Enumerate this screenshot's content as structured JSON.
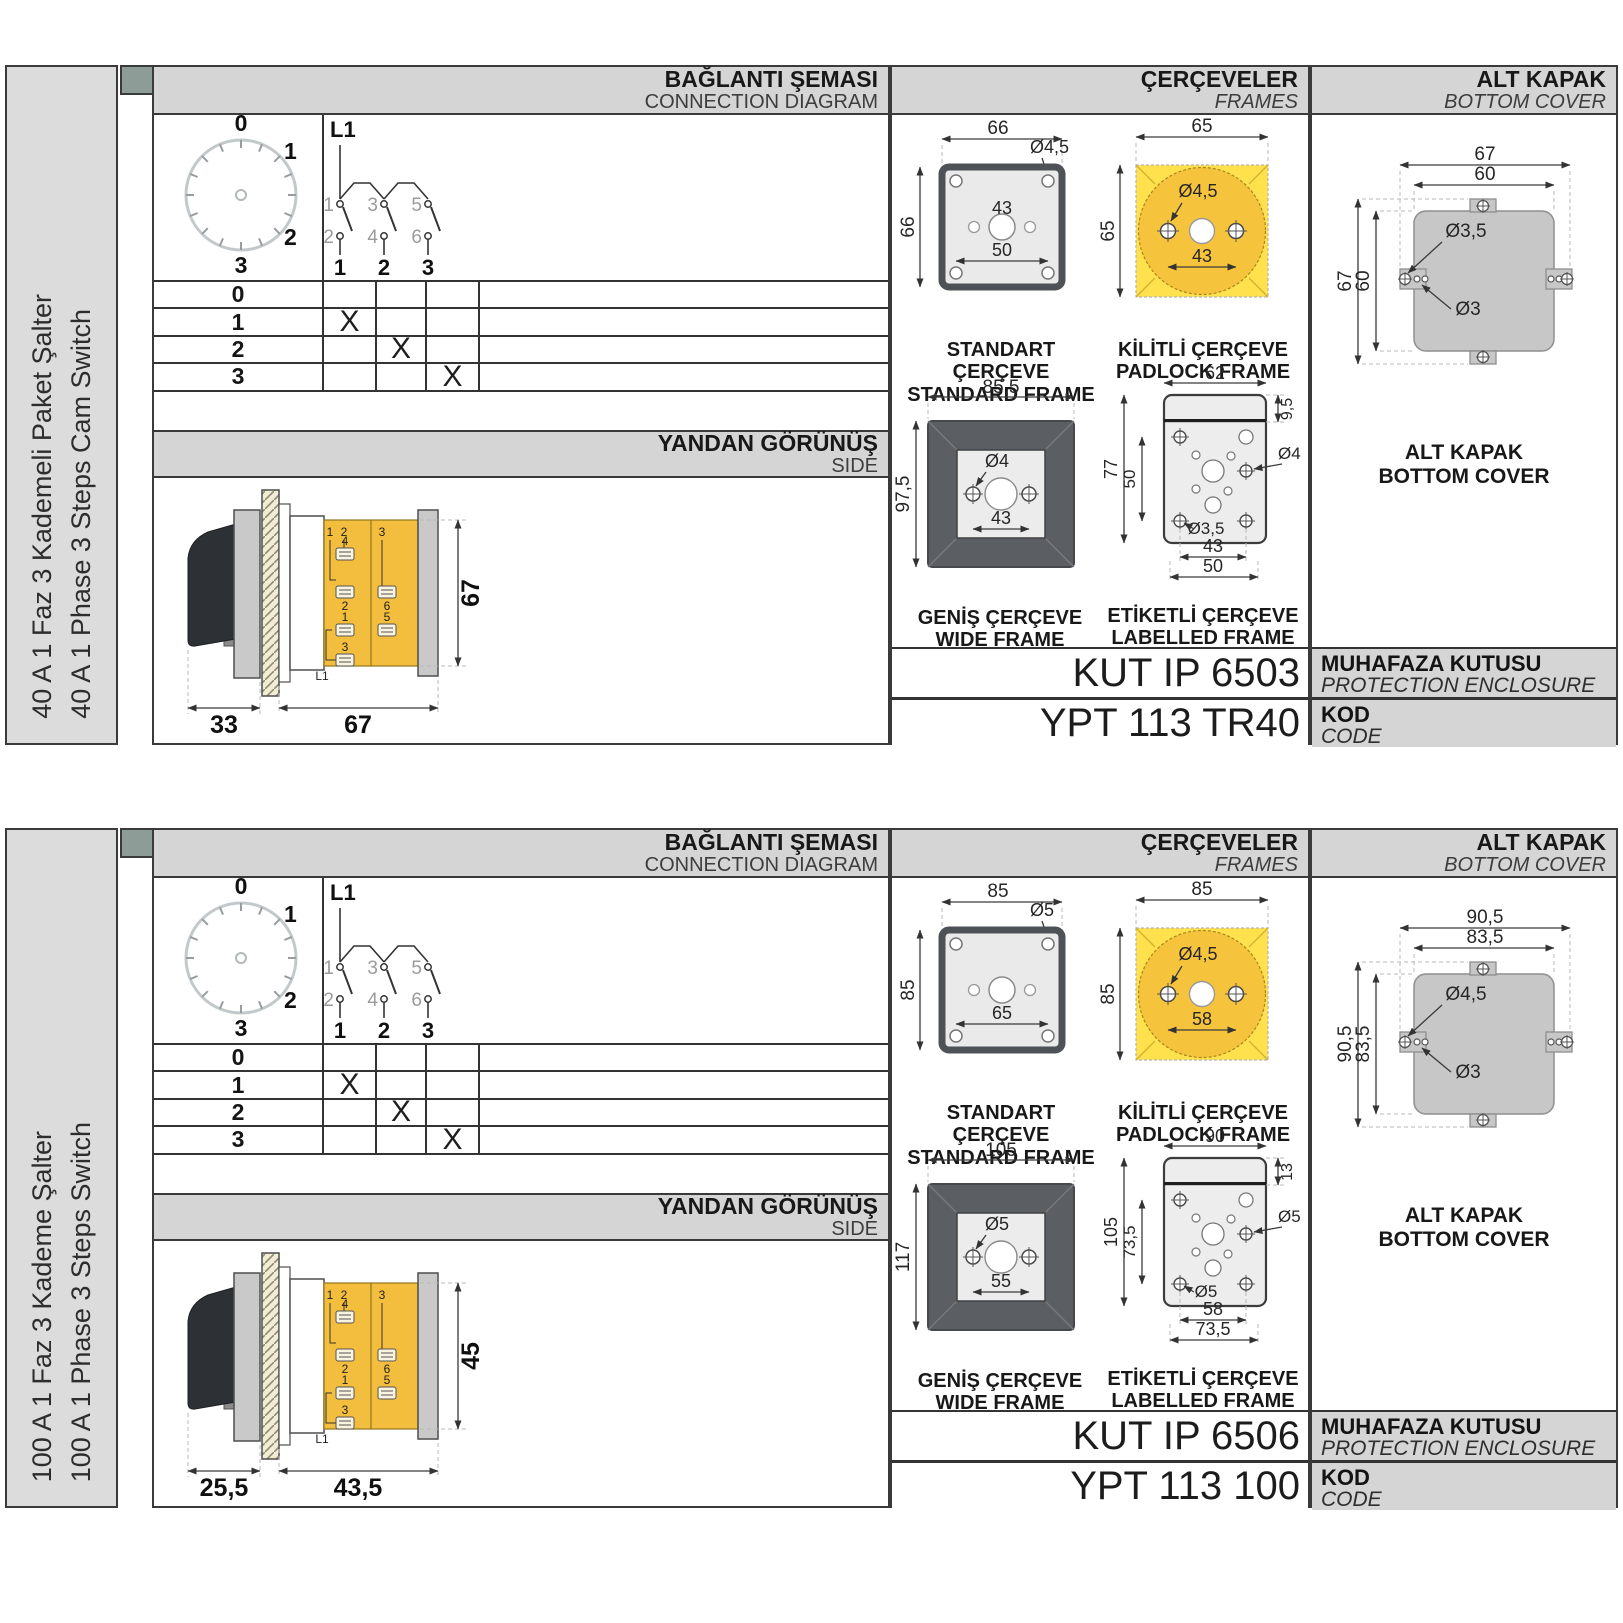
{
  "colors": {
    "header_bg": "#d5d5d5",
    "sidebar_bg": "#dcdcdc",
    "corner_square": "#8d9c96",
    "padlock_yellow_light": "#ffe14e",
    "padlock_yellow_dark": "#f6c33c",
    "switch_body_yellow": "#f3bd3e",
    "wide_frame_grey": "#5b5f64",
    "panel_light_grey": "#eaeaea",
    "cover_grey": "#c7c7c7",
    "line_dark": "#3a3a3a"
  },
  "sections": [
    {
      "sidebar": {
        "tr": "40 A 1 Faz 3 Kademeli Paket Şalter",
        "en": "40 A 1 Phase 3 Steps Cam Switch"
      },
      "connection": {
        "title_tr": "BAĞLANTI ŞEMASI",
        "title_en": "CONNECTION DIAGRAM",
        "dial": [
          "0",
          "1",
          "2",
          "3"
        ],
        "schematic": {
          "phase": "L1",
          "top": [
            "1",
            "3",
            "5"
          ],
          "bottom": [
            "2",
            "4",
            "6"
          ],
          "cols": [
            "1",
            "2",
            "3"
          ]
        },
        "table": {
          "rows": [
            "0",
            "1",
            "2",
            "3"
          ],
          "cells": [
            [
              "",
              "",
              ""
            ],
            [
              "X",
              "",
              ""
            ],
            [
              "",
              "X",
              ""
            ],
            [
              "",
              "",
              "X"
            ]
          ]
        }
      },
      "side": {
        "title_tr": "YANDAN GÖRÜNÜŞ",
        "title_en": "SIDE",
        "dims": {
          "handle": "33",
          "body": "67",
          "height": "67"
        },
        "labels": [
          "1",
          "2",
          "3",
          "4",
          "2",
          "6",
          "1",
          "5",
          "3",
          "L1"
        ]
      },
      "frames": {
        "title_tr": "ÇERÇEVELER",
        "title_en": "FRAMES",
        "standard": {
          "tr": "STANDART ÇERÇEVE",
          "en": "STANDARD FRAME",
          "w": "66",
          "h": "66",
          "hole": "Ø4,5",
          "d_mid": "43",
          "d_bot": "50"
        },
        "padlock": {
          "tr": "KİLİTLİ ÇERÇEVE",
          "en": "PADLOCK FRAME",
          "w": "65",
          "h": "65",
          "hole": "Ø4,5",
          "d1": "43"
        },
        "wide": {
          "tr": "GENİŞ ÇERÇEVE",
          "en": "WIDE FRAME",
          "w": "85,5",
          "h": "97,5",
          "hole": "Ø4",
          "d1": "43"
        },
        "labelled": {
          "tr": "ETİKETLİ ÇERÇEVE",
          "en": "LABELLED FRAME",
          "w": "62",
          "h": "77",
          "h2": "50",
          "strip": "9,5",
          "hole1": "Ø4",
          "hole2": "Ø3,5",
          "d1": "43",
          "d2": "50"
        }
      },
      "cover": {
        "title_tr": "ALT KAPAK",
        "title_en": "BOTTOM COVER",
        "cap_tr": "ALT KAPAK",
        "cap_en": "BOTTOM COVER",
        "w1": "67",
        "w2": "60",
        "h1": "67",
        "h2": "60",
        "hole1": "Ø3,5",
        "hole2": "Ø3"
      },
      "codes": {
        "enclosure": "KUT IP 6503",
        "code": "YPT 113 TR40",
        "mk_tr": "MUHAFAZA KUTUSU",
        "mk_en": "PROTECTION ENCLOSURE",
        "kod_tr": "KOD",
        "kod_en": "CODE"
      }
    },
    {
      "sidebar": {
        "tr": "100 A 1 Faz 3 Kademe Şalter",
        "en": "100 A 1 Phase 3 Steps Switch"
      },
      "connection": {
        "title_tr": "BAĞLANTI ŞEMASI",
        "title_en": "CONNECTION DIAGRAM",
        "dial": [
          "0",
          "1",
          "2",
          "3"
        ],
        "schematic": {
          "phase": "L1",
          "top": [
            "1",
            "3",
            "5"
          ],
          "bottom": [
            "2",
            "4",
            "6"
          ],
          "cols": [
            "1",
            "2",
            "3"
          ]
        },
        "table": {
          "rows": [
            "0",
            "1",
            "2",
            "3"
          ],
          "cells": [
            [
              "",
              "",
              ""
            ],
            [
              "X",
              "",
              ""
            ],
            [
              "",
              "X",
              ""
            ],
            [
              "",
              "",
              "X"
            ]
          ]
        }
      },
      "side": {
        "title_tr": "YANDAN GÖRÜNÜŞ",
        "title_en": "SIDE",
        "dims": {
          "handle": "25,5",
          "body": "43,5",
          "height": "45"
        },
        "labels": [
          "1",
          "2",
          "3",
          "4",
          "2",
          "6",
          "1",
          "5",
          "3",
          "L1"
        ]
      },
      "frames": {
        "title_tr": "ÇERÇEVELER",
        "title_en": "FRAMES",
        "standard": {
          "tr": "STANDART ÇERÇEVE",
          "en": "STANDARD FRAME",
          "w": "85",
          "h": "85",
          "hole": "Ø5",
          "d_mid": "",
          "d_bot": "65"
        },
        "padlock": {
          "tr": "KİLİTLİ ÇERÇEVE",
          "en": "PADLOCK FRAME",
          "w": "85",
          "h": "85",
          "hole": "Ø4,5",
          "d1": "58"
        },
        "wide": {
          "tr": "GENİŞ ÇERÇEVE",
          "en": "WIDE FRAME",
          "w": "105",
          "h": "117",
          "hole": "Ø5",
          "d1": "55"
        },
        "labelled": {
          "tr": "ETİKETLİ ÇERÇEVE",
          "en": "LABELLED FRAME",
          "w": "90",
          "h": "105",
          "h2": "73,5",
          "strip": "13",
          "hole1": "Ø5",
          "hole2": "Ø5",
          "d1": "58",
          "d2": "73,5"
        }
      },
      "cover": {
        "title_tr": "ALT KAPAK",
        "title_en": "BOTTOM COVER",
        "cap_tr": "ALT KAPAK",
        "cap_en": "BOTTOM COVER",
        "w1": "90,5",
        "w2": "83,5",
        "h1": "90,5",
        "h2": "83,5",
        "hole1": "Ø4,5",
        "hole2": "Ø3"
      },
      "codes": {
        "enclosure": "KUT IP 6506",
        "code": "YPT 113 100",
        "mk_tr": "MUHAFAZA KUTUSU",
        "mk_en": "PROTECTION ENCLOSURE",
        "kod_tr": "KOD",
        "kod_en": "CODE"
      }
    }
  ]
}
